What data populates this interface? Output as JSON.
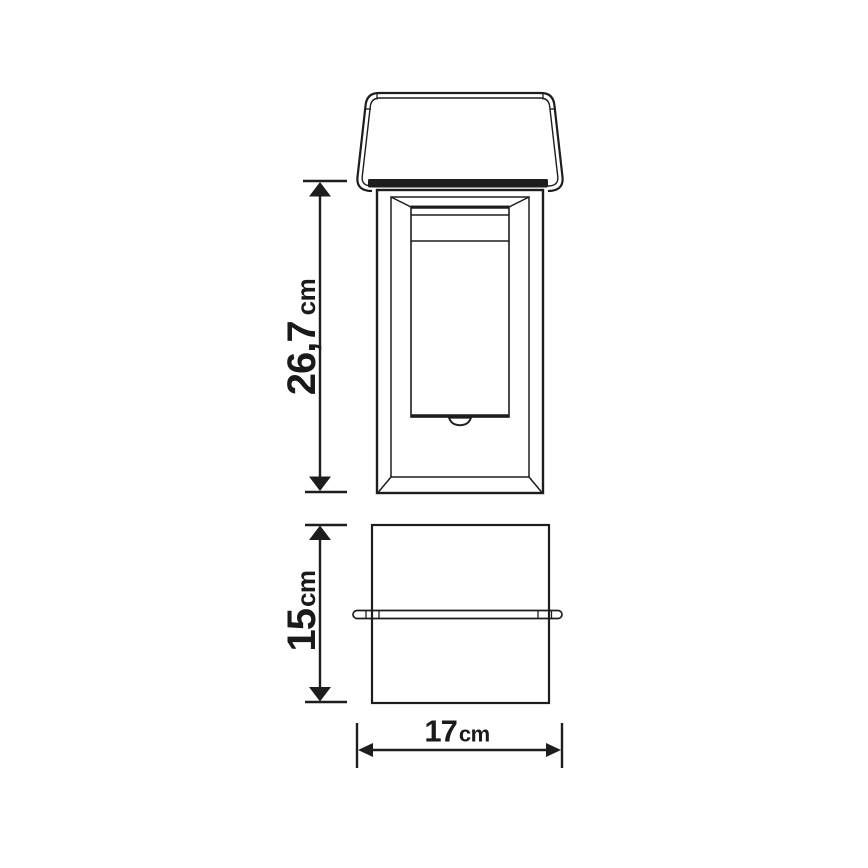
{
  "drawing": {
    "kind": "product dimension diagram",
    "background": "#ffffff",
    "line_color": "#1d1d1d",
    "text_color": "#1a1a1a"
  },
  "dimensions": {
    "height": {
      "value": "26,7",
      "unit": "cm"
    },
    "depth": {
      "value": "15",
      "unit": "cm"
    },
    "width": {
      "value": "17",
      "unit": "cm"
    }
  }
}
